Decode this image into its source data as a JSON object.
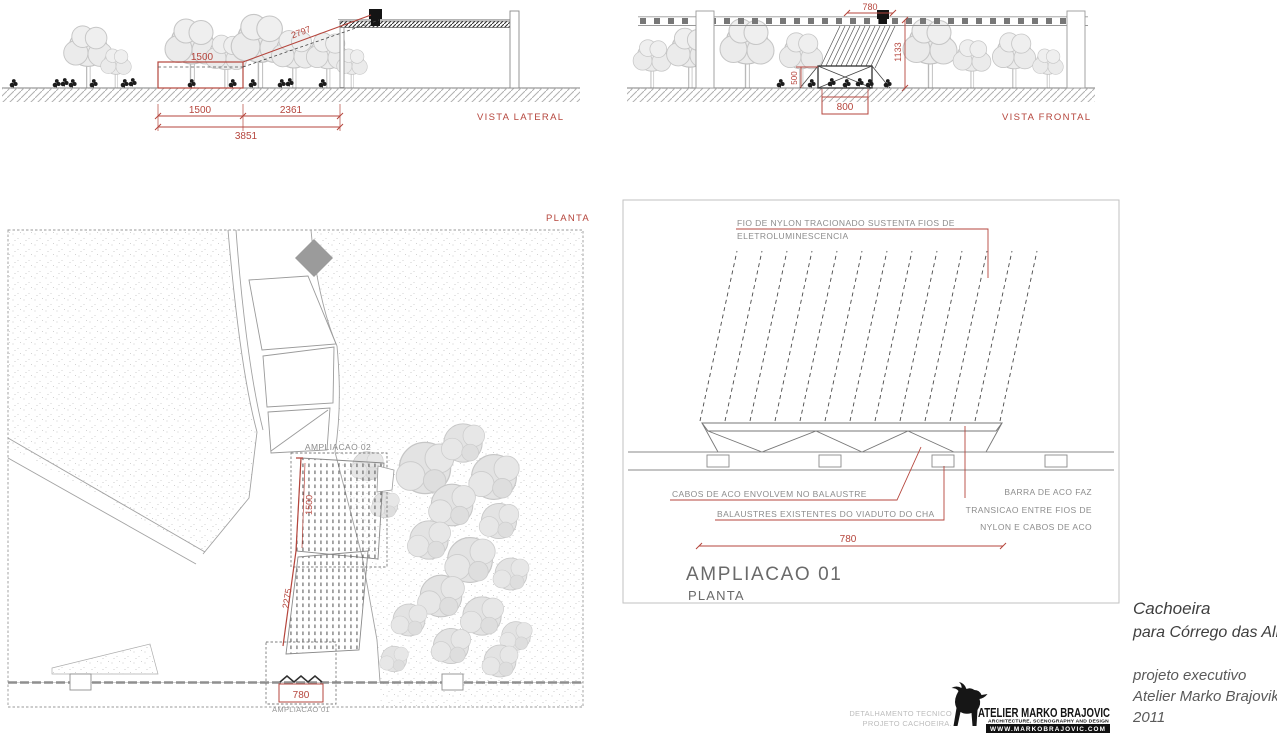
{
  "colors": {
    "accent_red": "#b5453c",
    "line_gray": "#9a9a9a",
    "dark_line": "#2f2f2f",
    "tree_gray": "#d9d9d9",
    "annotation_gray": "#8c8c8c"
  },
  "vista_lateral": {
    "label": "VISTA LATERAL",
    "dim_top_width": "1500",
    "dim_diagonal": "2797",
    "dim_bottom_left": "1500",
    "dim_bottom_right": "2361",
    "dim_bottom_total": "3851"
  },
  "vista_frontal": {
    "label": "VISTA FRONTAL",
    "dim_top": "780",
    "dim_height": "1133",
    "dim_screen_height": "500",
    "dim_base": "800"
  },
  "planta": {
    "label": "PLANTA",
    "ampliacao_02": "AMPLIACAO 02",
    "ampliacao_01": "AMPLIACAO 01",
    "dim_deck": "1500",
    "dim_ramp": "2275",
    "dim_width": "780"
  },
  "detail": {
    "title": "AMPLIACAO 01",
    "subtitle": "PLANTA",
    "ann_nylon_1": "FIO DE NYLON TRACIONADO SUSTENTA  FIOS DE",
    "ann_nylon_2": "ELETROLUMINESCENCIA",
    "ann_cabos": "CABOS DE ACO ENVOLVEM NO BALAUSTRE",
    "ann_balaustres": "BALAUSTRES EXISTENTES DO VIADUTO DO CHA",
    "ann_barra_1": "BARRA DE ACO FAZ",
    "ann_barra_2": "TRANSICAO ENTRE FIOS DE",
    "ann_barra_3": "NYLON E CABOS DE ACO",
    "dim_width": "780"
  },
  "title_block": {
    "project_1": "Cachoeira",
    "project_2": "para Córrego das Almas",
    "phase": "projeto executivo",
    "studio": "Atelier Marko Brajovik",
    "year": "2011",
    "sheet_1": "DETALHAMENTO TECNICO",
    "sheet_2": "PROJETO CACHOEIRA.",
    "logo_name": "ATELIER MARKO BRAJOVIC",
    "logo_tagline": "ARCHITECTURE, SCENOGRAPHY AND DESIGN",
    "logo_site": "WWW.MARKOBRAJOVIC.COM"
  }
}
